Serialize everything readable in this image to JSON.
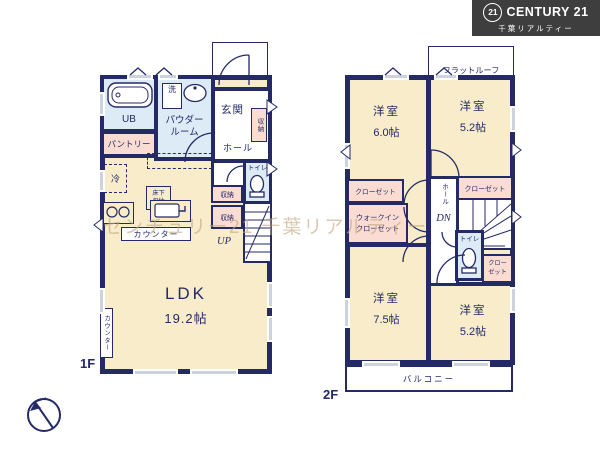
{
  "watermark": "センチュリー21 千葉リアルティー",
  "logo": {
    "badge": "21",
    "brand": "CENTURY 21",
    "company": "千葉リアルティー"
  },
  "colors": {
    "wall_navy": "#242a66",
    "room_cream": "#f8ecca",
    "room_blue": "#dcebf5",
    "room_pink": "#fbdcd2",
    "window_gray": "#ccd2de",
    "logo_background": "#3e3e3e",
    "watermark_tan": "#c4a880"
  },
  "floor1": {
    "label": "1F",
    "ub": "UB",
    "wash": "洗",
    "powder_line1": "パウダー",
    "powder_line2": "ルーム",
    "entrance": "玄関",
    "hall": "ホール",
    "entrance_storage": "収納",
    "pantry": "パントリー",
    "fridge": "冷",
    "underfloor_line1": "床下",
    "underfloor_line2": "収納",
    "counter": "カウンター",
    "storage_a": "収納",
    "storage_b": "収納",
    "toilet": "トイレ",
    "up": "UP",
    "ldk_name": "LDK",
    "ldk_size": "19.2帖",
    "side_counter": "カウンター"
  },
  "floor2": {
    "label": "2F",
    "flat_roof": "フラットルーフ",
    "rooms": {
      "nw": {
        "name": "洋室",
        "size": "6.0帖"
      },
      "ne": {
        "name": "洋室",
        "size": "5.2帖"
      },
      "sw": {
        "name": "洋室",
        "size": "7.5帖"
      },
      "se": {
        "name": "洋室",
        "size": "5.2帖"
      }
    },
    "closet_west": "クローゼット",
    "wic_line1": "ウォークイン",
    "wic_line2": "クローゼット",
    "hall": "ホール",
    "dn": "DN",
    "closet_east": "クローゼット",
    "toilet": "トイレ",
    "closet_se_line1": "クロー",
    "closet_se_line2": "ゼット",
    "balcony": "バルコニー"
  }
}
